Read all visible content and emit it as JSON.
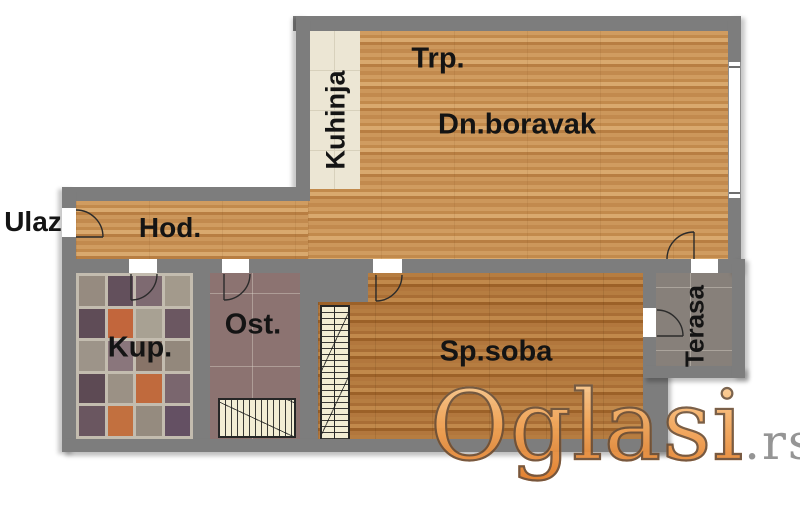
{
  "rooms": {
    "entrance": {
      "label": "Ulaz"
    },
    "hallway": {
      "label": "Hod."
    },
    "kitchen": {
      "label": "Kuhinja"
    },
    "dining": {
      "label": "Trp."
    },
    "living_room": {
      "label": "Dn.boravak"
    },
    "bathroom": {
      "label": "Kup."
    },
    "storage": {
      "label": "Ost."
    },
    "bedroom": {
      "label": "Sp.soba"
    },
    "terrace": {
      "label": "Terasa"
    }
  },
  "watermark": {
    "brand": "Oglasi",
    "tld": ".rs"
  },
  "palette": {
    "wall_gray": "#7d7d7d",
    "wood_light": "#c9955a",
    "wood_dark": "#ad7440",
    "kitchen_tile": "#ece6d4",
    "bathroom_accent_orange": "#c2663c",
    "bathroom_dark_tile": "#5f4c57",
    "storage_floor": "#8c7371",
    "terrace_floor": "#87807a",
    "furniture_fill": "#f3edd4",
    "watermark_orange": "#e8872f",
    "watermark_gray": "#8d8d8d"
  }
}
